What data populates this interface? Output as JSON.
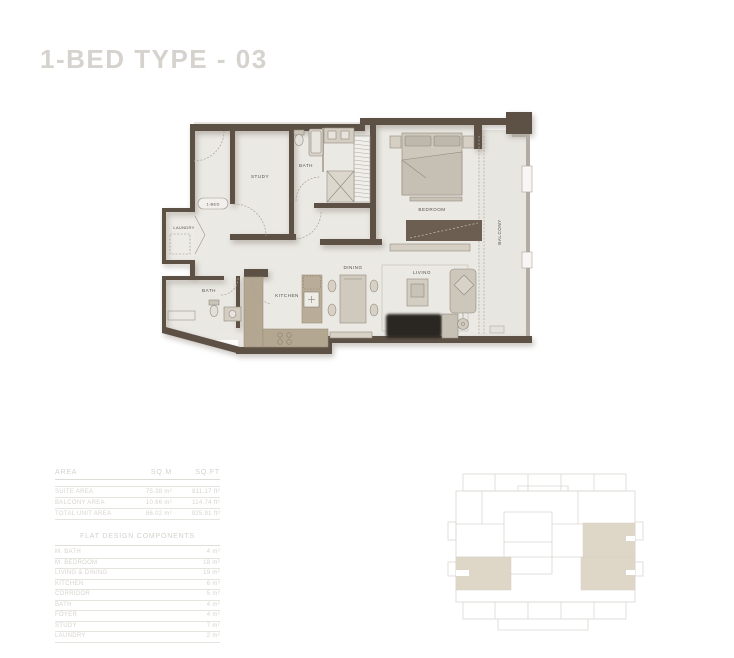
{
  "title": "1-BED TYPE - 03",
  "floorplan": {
    "labels": {
      "unit": "1-BED",
      "study": "STUDY",
      "bath_top": "BATH",
      "bedroom": "BEDROOM",
      "balcony": "BALCONY",
      "laundry": "LAUNDRY",
      "bath_bottom": "BATH",
      "kitchen": "KITCHEN",
      "dining": "DINING",
      "living": "LIVING"
    }
  },
  "area_table": {
    "headers": {
      "area": "AREA",
      "sqm": "SQ.M",
      "sqft": "SQ.FT"
    },
    "rows": [
      {
        "name": "SUITE AREA",
        "sqm": "75.38 m²",
        "sqft": "811.17 ft²"
      },
      {
        "name": "BALCONY AREA",
        "sqm": "10.66 m²",
        "sqft": "114.74 ft²"
      },
      {
        "name": "TOTAL UNIT AREA",
        "sqm": "86.02 m²",
        "sqft": "925.91 ft²"
      }
    ]
  },
  "components_table": {
    "title": "FLAT DESIGN COMPONENTS",
    "rows": [
      {
        "name": "M. BATH",
        "value": "4 m²"
      },
      {
        "name": "M. BEDROOM",
        "value": "18 m²"
      },
      {
        "name": "LIVING & DINING",
        "value": "19 m²"
      },
      {
        "name": "KITCHEN",
        "value": "6 m²"
      },
      {
        "name": "CORRIDOR",
        "value": "5 m²"
      },
      {
        "name": "BATH",
        "value": "4 m²"
      },
      {
        "name": "FOYER",
        "value": "4 m²"
      },
      {
        "name": "STUDY",
        "value": "7 m²"
      },
      {
        "name": "LAUNDRY",
        "value": "2 m²"
      }
    ]
  },
  "colors": {
    "wall": "#5d5145",
    "floor": "#ebe9e4",
    "balcony_floor": "#e8e6e1",
    "counter": "#b4a791",
    "furniture": "#d2ccc1",
    "keyplan_highlight": "#ded7c8",
    "title_text": "#d6d3ce",
    "table_text": "#d7d4ce"
  }
}
